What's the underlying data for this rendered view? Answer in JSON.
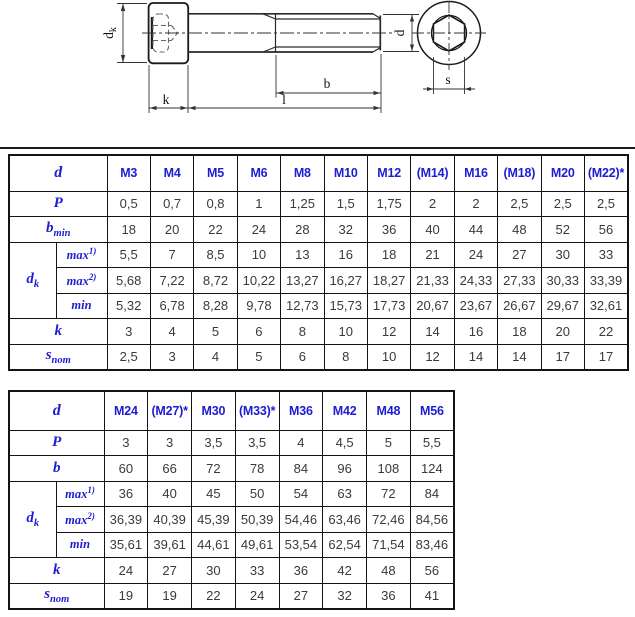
{
  "drawing": {
    "labels": {
      "dk_base": "d",
      "dk_sub": "k",
      "k": "k",
      "l": "l",
      "b": "b",
      "d": "d",
      "s": "s"
    }
  },
  "t1": {
    "corner": "d",
    "cols": [
      "M3",
      "M4",
      "M5",
      "M6",
      "M8",
      "M10",
      "M12",
      "(M14)",
      "M16",
      "(M18)",
      "M20",
      "(M22)*"
    ],
    "p": {
      "label": "P",
      "v": [
        "0,5",
        "0,7",
        "0,8",
        "1",
        "1,25",
        "1,5",
        "1,75",
        "2",
        "2",
        "2,5",
        "2,5",
        "2,5"
      ]
    },
    "b": {
      "label": "b",
      "sub": "min",
      "v": [
        "18",
        "20",
        "22",
        "24",
        "28",
        "32",
        "36",
        "40",
        "44",
        "48",
        "52",
        "56"
      ]
    },
    "dk": {
      "label": "d",
      "sub": "k"
    },
    "max1": {
      "label": "max",
      "sup": "1)",
      "v": [
        "5,5",
        "7",
        "8,5",
        "10",
        "13",
        "16",
        "18",
        "21",
        "24",
        "27",
        "30",
        "33"
      ]
    },
    "max2": {
      "label": "max",
      "sup": "2)",
      "v": [
        "5,68",
        "7,22",
        "8,72",
        "10,22",
        "13,27",
        "16,27",
        "18,27",
        "21,33",
        "24,33",
        "27,33",
        "30,33",
        "33,39"
      ]
    },
    "min": {
      "label": "min",
      "v": [
        "5,32",
        "6,78",
        "8,28",
        "9,78",
        "12,73",
        "15,73",
        "17,73",
        "20,67",
        "23,67",
        "26,67",
        "29,67",
        "32,61"
      ]
    },
    "k": {
      "label": "k",
      "v": [
        "3",
        "4",
        "5",
        "6",
        "8",
        "10",
        "12",
        "14",
        "16",
        "18",
        "20",
        "22"
      ]
    },
    "snom": {
      "label": "s",
      "sub": "nom",
      "v": [
        "2,5",
        "3",
        "4",
        "5",
        "6",
        "8",
        "10",
        "12",
        "14",
        "14",
        "17",
        "17"
      ]
    }
  },
  "t2": {
    "corner": "d",
    "cols": [
      "M24",
      "(M27)*",
      "M30",
      "(M33)*",
      "M36",
      "M42",
      "M48",
      "M56"
    ],
    "p": {
      "label": "P",
      "v": [
        "3",
        "3",
        "3,5",
        "3,5",
        "4",
        "4,5",
        "5",
        "5,5"
      ]
    },
    "b": {
      "label": "b",
      "v": [
        "60",
        "66",
        "72",
        "78",
        "84",
        "96",
        "108",
        "124"
      ]
    },
    "dk": {
      "label": "d",
      "sub": "k"
    },
    "max1": {
      "label": "max",
      "sup": "1)",
      "v": [
        "36",
        "40",
        "45",
        "50",
        "54",
        "63",
        "72",
        "84"
      ]
    },
    "max2": {
      "label": "max",
      "sup": "2)",
      "v": [
        "36,39",
        "40,39",
        "45,39",
        "50,39",
        "54,46",
        "63,46",
        "72,46",
        "84,56"
      ]
    },
    "min": {
      "label": "min",
      "v": [
        "35,61",
        "39,61",
        "44,61",
        "49,61",
        "53,54",
        "62,54",
        "71,54",
        "83,46"
      ]
    },
    "k": {
      "label": "k",
      "v": [
        "24",
        "27",
        "30",
        "33",
        "36",
        "42",
        "48",
        "56"
      ]
    },
    "snom": {
      "label": "s",
      "sub": "nom",
      "v": [
        "19",
        "19",
        "22",
        "24",
        "27",
        "32",
        "36",
        "41"
      ]
    }
  }
}
